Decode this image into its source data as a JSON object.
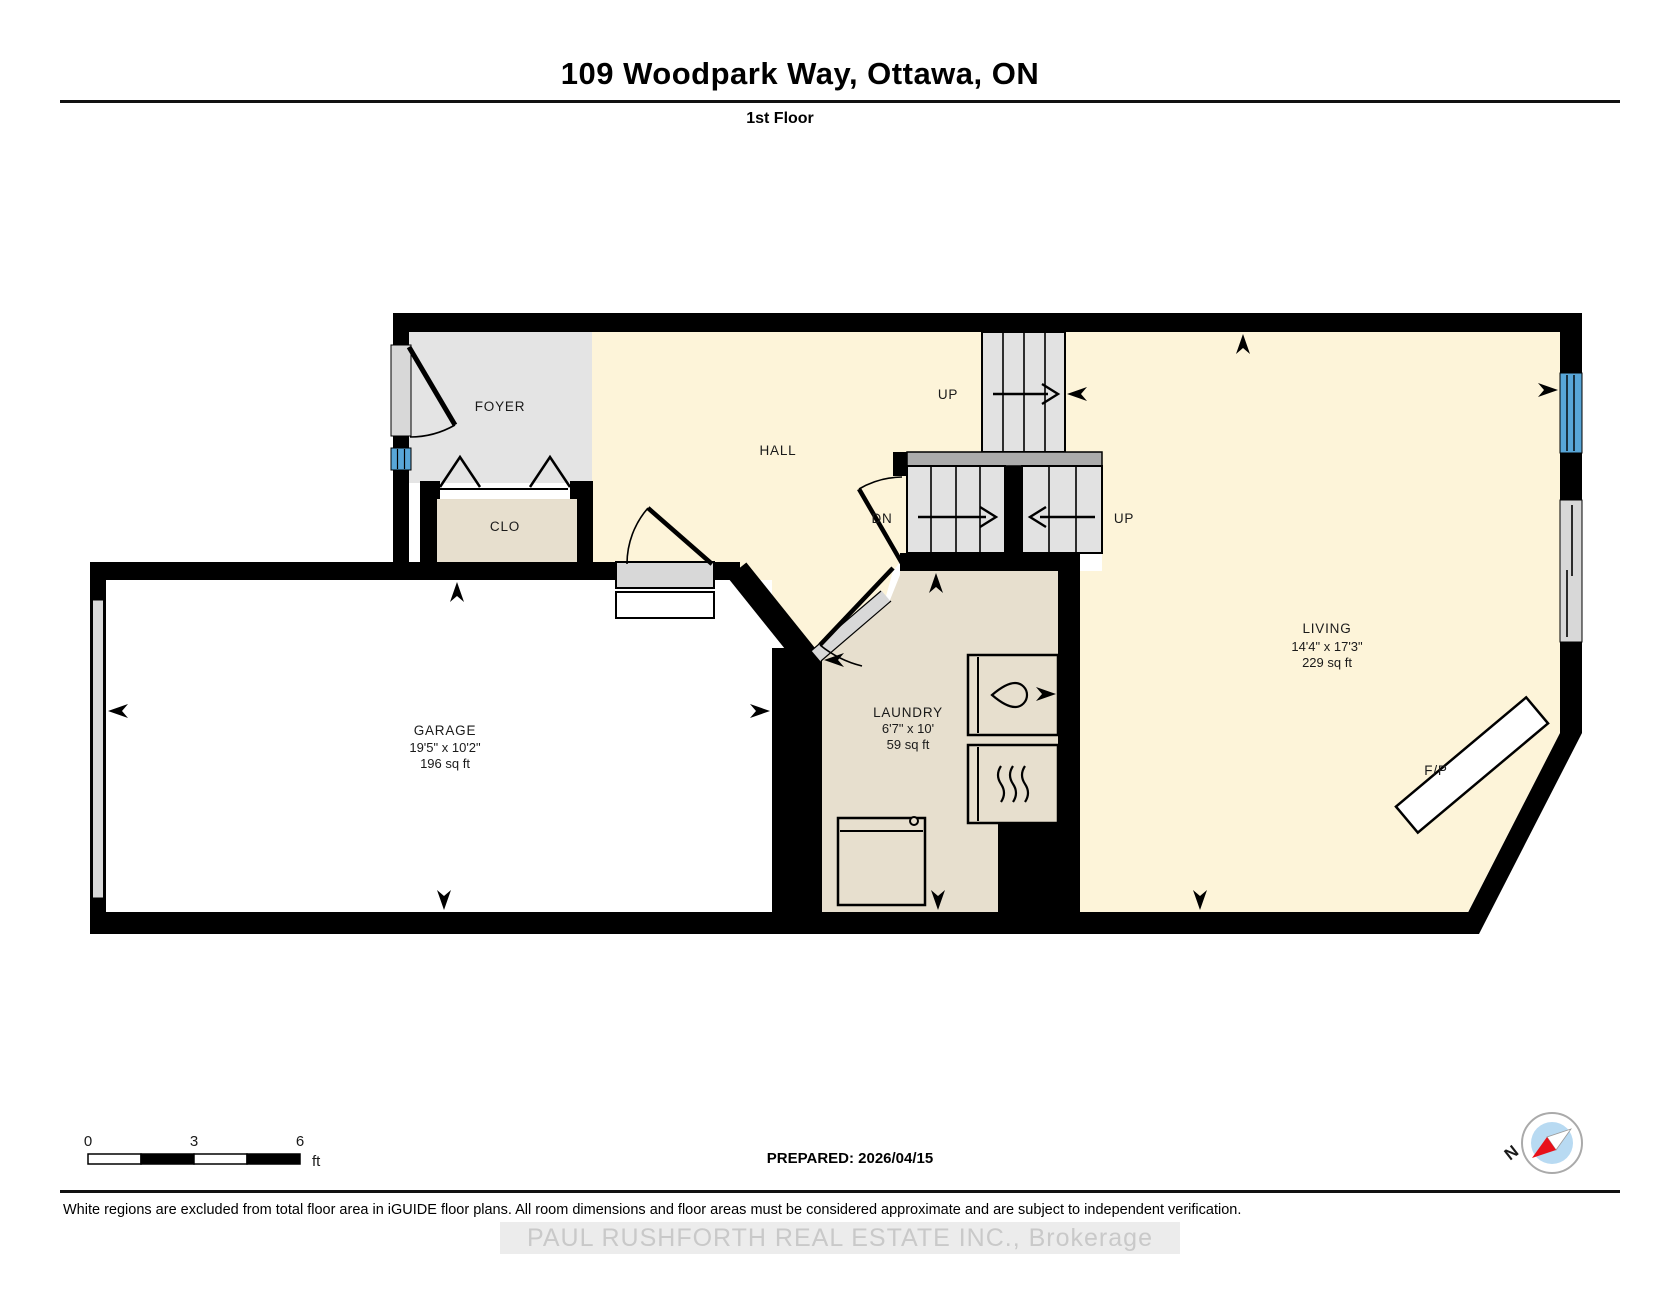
{
  "header": {
    "title": "109 Woodpark Way, Ottawa, ON",
    "floor_label": "1st Floor"
  },
  "rooms": {
    "foyer": {
      "name": "FOYER"
    },
    "hall": {
      "name": "HALL"
    },
    "closet": {
      "name": "CLO"
    },
    "garage": {
      "name": "GARAGE",
      "dimensions": "19'5\" x 10'2\"",
      "area": "196 sq ft"
    },
    "laundry": {
      "name": "LAUNDRY",
      "dimensions": "6'7\" x 10'",
      "area": "59 sq ft"
    },
    "living": {
      "name": "LIVING",
      "dimensions": "14'4\" x 17'3\"",
      "area": "229 sq ft"
    },
    "fireplace": {
      "name": "F/P"
    }
  },
  "stairs": {
    "up_top_label": "UP",
    "down_label": "DN",
    "up_right_label": "UP"
  },
  "scale_bar": {
    "start": "0",
    "mid": "3",
    "end": "6",
    "unit": "ft"
  },
  "prepared_label": "PREPARED: 2026/04/15",
  "compass": {
    "north_label": "N"
  },
  "footer": {
    "disclaimer": "White regions are excluded from total floor area in iGUIDE floor plans. All room dimensions and floor areas must be considered approximate and are subject to independent verification.",
    "watermark": "PAUL RUSHFORTH REAL ESTATE INC., Brokerage"
  },
  "colors": {
    "wall": "#000000",
    "room_warm": "#fdf4d9",
    "room_gray": "#e4e4e4",
    "room_beige": "#e7dfce",
    "window_blue": "#58a6d8",
    "stair_tread": "#e2e2e2",
    "landing_gray": "#ababab",
    "door_gray": "#d8d8d8",
    "compass_red": "#e8111a"
  }
}
